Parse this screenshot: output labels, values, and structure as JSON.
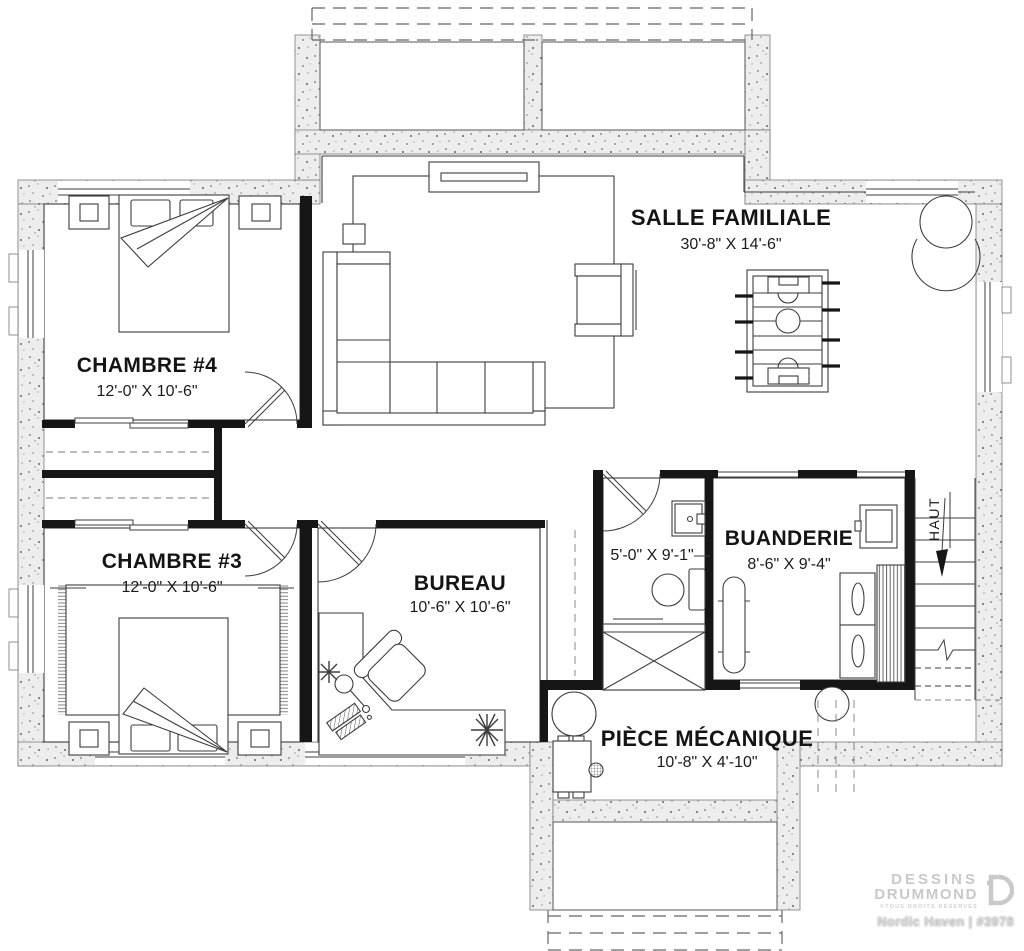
{
  "plan_title": "Basement floor plan",
  "rooms": {
    "salle_familiale": {
      "name": "SALLE FAMILIALE",
      "dims": "30'-8\" X 14'-6\""
    },
    "chambre4": {
      "name": "CHAMBRE #4",
      "dims": "12'-0\" X 10'-6\""
    },
    "chambre3": {
      "name": "CHAMBRE #3",
      "dims": "12'-0\" X 10'-6\""
    },
    "bureau": {
      "name": "BUREAU",
      "dims": "10'-6\" X 10'-6\""
    },
    "salle_de_bain": {
      "dims": "5'-0\" X 9'-1\""
    },
    "buanderie": {
      "name": "BUANDERIE",
      "dims": "8'-6\" X 9'-4\""
    },
    "piece_mecanique": {
      "name": "PIÈCE MÉCANIQUE",
      "dims": "10'-8\" X 4'-10\""
    }
  },
  "stairs": {
    "direction_label": "HAUT"
  },
  "brand": {
    "line1": "DESSINS",
    "line2": "DRUMMOND",
    "line3": "©TOUS DROITS RÉSERVÉS",
    "plan_name": "Nordic Haven | #3978"
  },
  "colors": {
    "interior_wall": "#161616",
    "concrete_fill": "#ededed",
    "line": "#3d3d3d",
    "brand_gray": "#c9c9c9"
  }
}
